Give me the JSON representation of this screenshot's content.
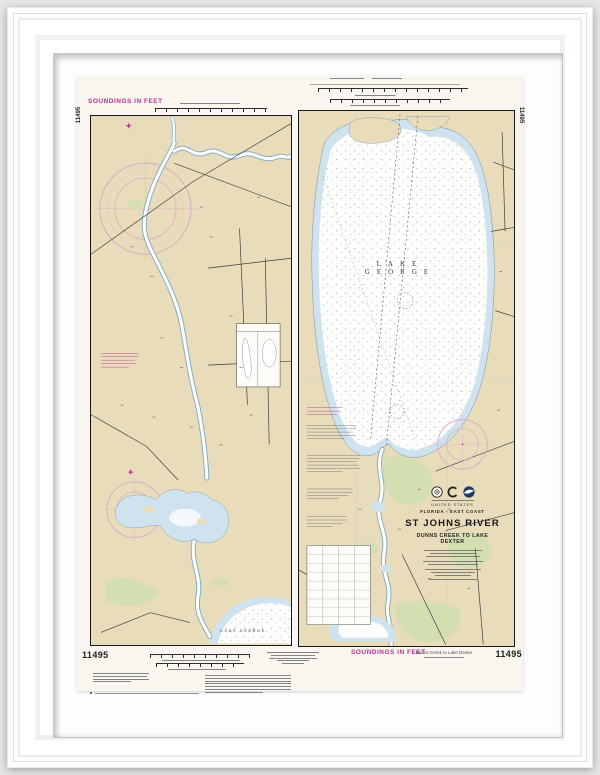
{
  "artwork": {
    "kind": "framed nautical chart print",
    "chart_number": "11495",
    "soundings_note_top": "SOUNDINGS IN FEET",
    "soundings_note_bottom": "SOUNDINGS IN FEET",
    "margin_number_left": "11495",
    "margin_number_right": "11495",
    "bottom_number_left": "11495",
    "bottom_number_right": "11495",
    "edition_note": "Dunns Creek to Lake Dexter",
    "lake_label_main": "LAKE GEORGE",
    "lake_label_small": "LAKE GEORGE",
    "title_block": {
      "country": "UNITED STATES",
      "region": "FLORIDA - EAST COAST",
      "title": "ST JOHNS RIVER",
      "subtitle": "DUNNS CREEK TO LAKE DEXTER"
    },
    "colors": {
      "magenta_ink": "#b5358e",
      "compass_rose_pink": "#dba9c9",
      "land_tan": "#e9dcba",
      "shallow_water_blue": "#cfe3ef",
      "deep_water_white": "#fdfdfc",
      "marsh_green": "#d3dfb0",
      "neatline_black": "#17171c",
      "noaa_logo_blue": "#1d3a66",
      "paper": "#f8f6ef",
      "mat": "#fdfdfd",
      "frame": "#ffffff"
    }
  }
}
